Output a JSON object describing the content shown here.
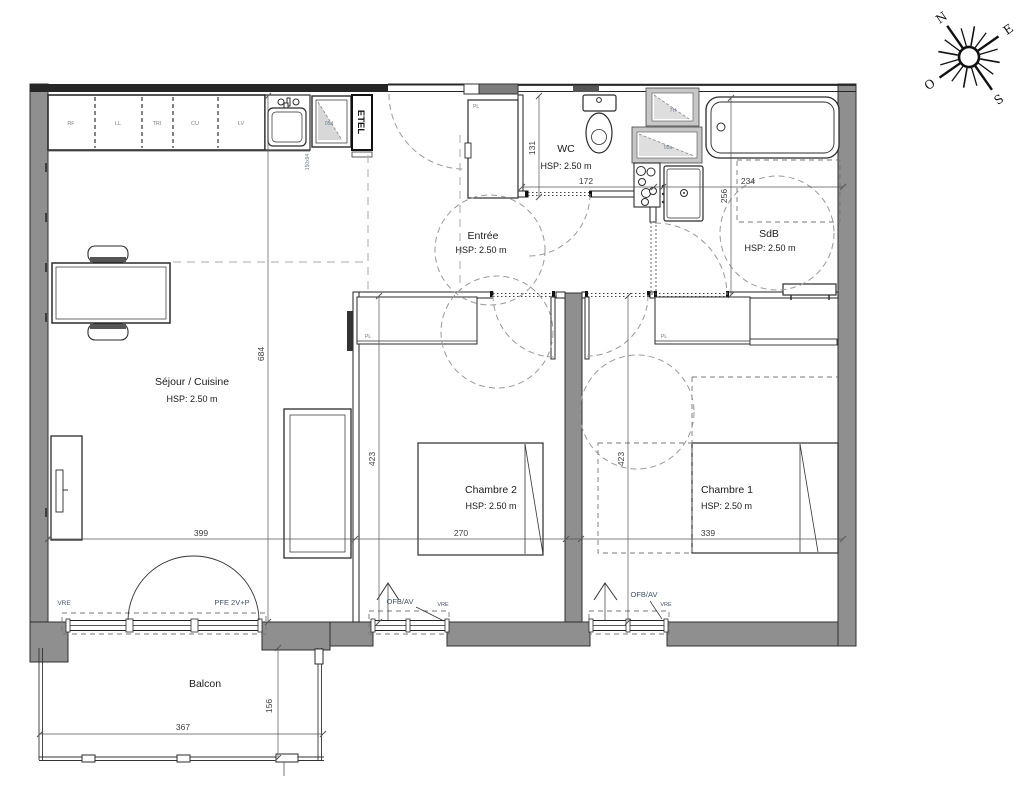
{
  "rooms": {
    "sejour": {
      "name": "Séjour / Cuisine",
      "height": "HSP: 2.50 m"
    },
    "entree": {
      "name": "Entrée",
      "height": "HSP: 2.50 m"
    },
    "wc": {
      "name": "WC",
      "height": "HSP: 2.50 m"
    },
    "sdb": {
      "name": "SdB",
      "height": "HSP: 2.50 m"
    },
    "chambre2": {
      "name": "Chambre 2",
      "height": "HSP: 2.50 m"
    },
    "chambre1": {
      "name": "Chambre 1",
      "height": "HSP: 2.50 m"
    },
    "balcon": {
      "name": "Balcon"
    }
  },
  "dims": {
    "sejour_h": "684",
    "sejour_w": "399",
    "ch2_w": "270",
    "ch2_h": "423",
    "ch1_w": "339",
    "ch1_h": "423",
    "wc_h": "131",
    "wc_w": "172",
    "sdb_w": "234",
    "sdb_h": "256",
    "balcon_w": "367",
    "balcon_h": "156"
  },
  "kitchen_units": [
    "RF",
    "LL",
    "TRI",
    "CU",
    "LV"
  ],
  "labels": {
    "closet": "PL",
    "vre": "VRE",
    "ofb": "OFB/AV",
    "pfe": "PFE 2V+P",
    "etel": "ETEL",
    "sink_dim": "150x94",
    "window_kitchen": "05d",
    "glazing_small": "7H",
    "glazing_large": "05a"
  },
  "compass": {
    "n": "N",
    "e": "E",
    "s": "S",
    "o": "O"
  },
  "colors": {
    "wall": "#8f8f8f",
    "line": "#1f1f1f",
    "dim": "#3c3c3c",
    "code": "#44546a"
  }
}
